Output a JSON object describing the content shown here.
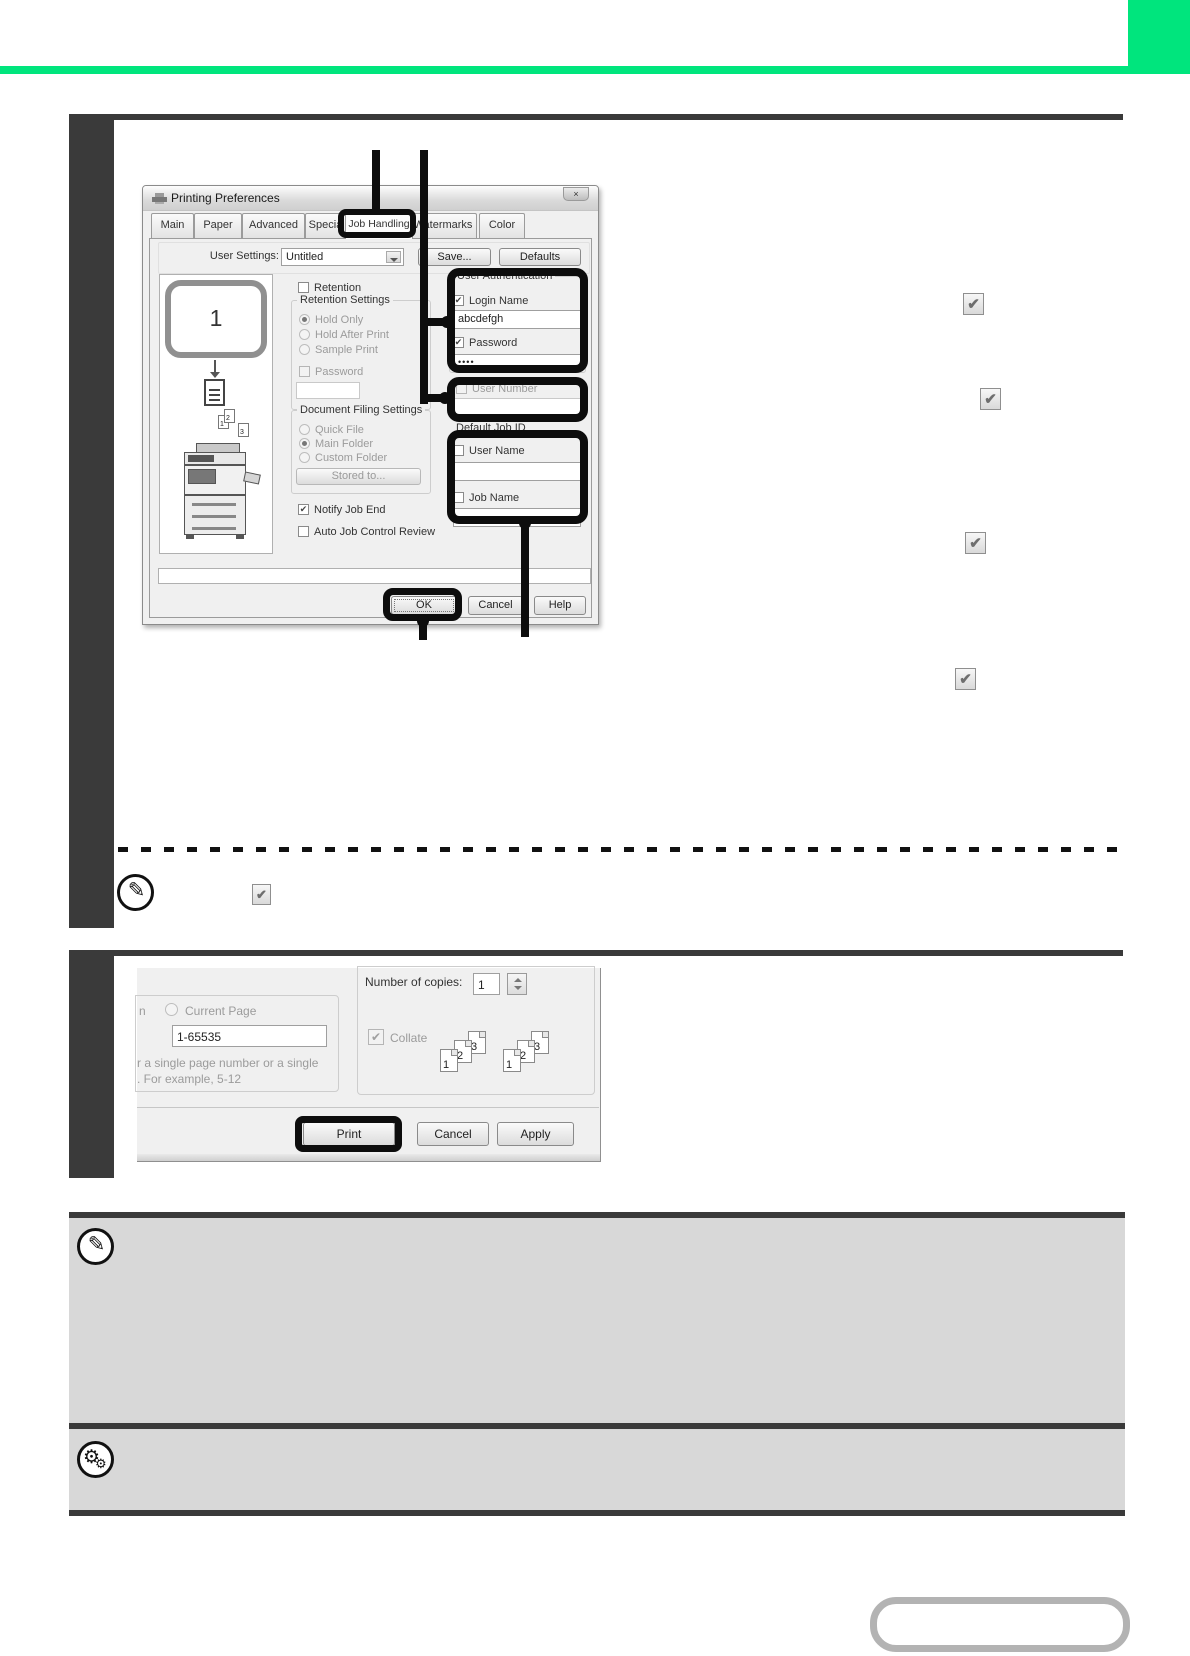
{
  "colors": {
    "accent_green": "#00e57d",
    "step_bar_dark": "#3a3a3a",
    "note_box_gray": "#d8d8d8",
    "callout_black": "#111111"
  },
  "icons": {
    "check": "✔",
    "pencil": "✎",
    "gear": "⚙",
    "close": "×"
  },
  "prefs_dialog": {
    "title": "Printing Preferences",
    "tabs": [
      "Main",
      "Paper",
      "Advanced",
      "Special Mode",
      "Job Handling",
      "Watermarks",
      "Color"
    ],
    "user_settings_label": "User Settings:",
    "user_settings_value": "Untitled",
    "save_button": "Save...",
    "defaults_button": "Defaults",
    "preview_page_number": "1",
    "retention_checkbox": "Retention",
    "retention_group_label": "Retention Settings",
    "radio_hold_only": "Hold Only",
    "radio_hold_after_print": "Hold After Print",
    "radio_sample_print": "Sample Print",
    "password_checkbox": "Password",
    "filing_group_label": "Document Filing Settings",
    "radio_quick_file": "Quick File",
    "radio_main_folder": "Main Folder",
    "radio_custom_folder": "Custom Folder",
    "stored_to_button": "Stored to...",
    "notify_job_end_checkbox": "Notify Job End",
    "auto_job_control_checkbox": "Auto Job Control Review",
    "auth_group_label": "User Authentication",
    "login_name_checkbox": "Login Name",
    "login_name_value": "abcdefgh",
    "password_auth_checkbox": "Password",
    "password_value": "••••",
    "user_number_checkbox": "User Number",
    "default_job_id_label": "Default Job ID",
    "user_name_checkbox": "User Name",
    "job_name_checkbox": "Job Name",
    "collate_digits": [
      "1",
      "2",
      "3"
    ],
    "ok_button": "OK",
    "cancel_button": "Cancel",
    "help_button": "Help"
  },
  "print_dialog": {
    "cut_text_left": "n",
    "current_page_radio": "Current Page",
    "page_range_value": "1-65535",
    "hint_line1": "r a single page number or a single",
    "hint_line2": ".  For example, 5-12",
    "copies_label": "Number of copies:",
    "copies_value": "1",
    "collate_checkbox": "Collate",
    "collate_digits": [
      "1",
      "2",
      "3"
    ],
    "print_button": "Print",
    "cancel_button": "Cancel",
    "apply_button": "Apply"
  }
}
